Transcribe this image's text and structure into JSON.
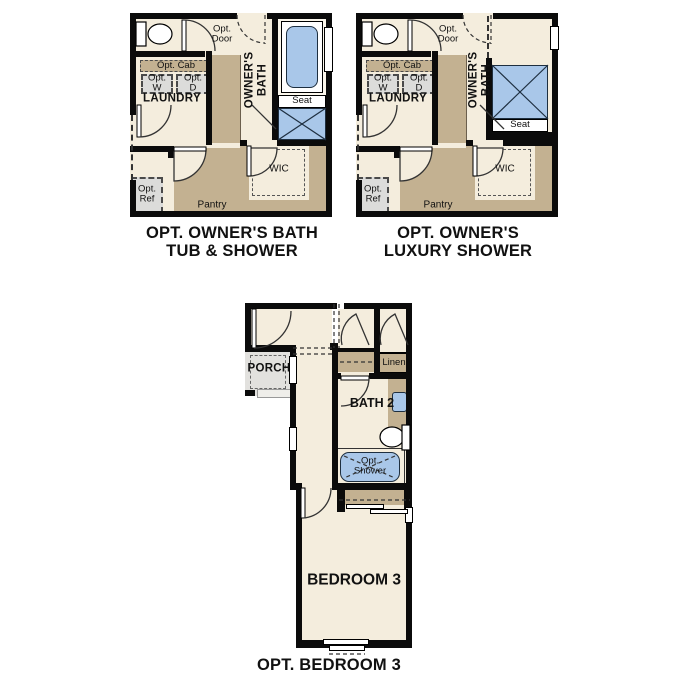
{
  "colors": {
    "background": "#ffffff",
    "floor_cream": "#F4EDDD",
    "counter_tan": "#C3B191",
    "optional_gray": "#DCDCDA",
    "fixture_blue": "#A9C7E9",
    "fixture_border": "#1E2F40",
    "wall_black": "#0b0b0b"
  },
  "plan_tub_shower": {
    "caption_line1": "OPT. OWNER'S BATH",
    "caption_line2": "TUB & SHOWER",
    "labels": {
      "opt_door_1": "Opt.",
      "opt_door_2": "Door",
      "owners_bath_1": "OWNER'S",
      "owners_bath_2": "BATH",
      "seat": "Seat",
      "opt_cab": "Opt. Cab",
      "opt_w_1": "Opt.",
      "opt_w_2": "W",
      "opt_d_1": "Opt.",
      "opt_d_2": "D",
      "laundry": "LAUNDRY",
      "opt_ref_1": "Opt.",
      "opt_ref_2": "Ref",
      "pantry": "Pantry",
      "wic": "WIC"
    }
  },
  "plan_luxury_shower": {
    "caption_line1": "OPT. OWNER'S",
    "caption_line2": "LUXURY SHOWER",
    "labels": {
      "opt_door_1": "Opt.",
      "opt_door_2": "Door",
      "owners_bath_1": "OWNER'S",
      "owners_bath_2": "BATH",
      "seat": "Seat",
      "opt_cab": "Opt. Cab",
      "opt_w_1": "Opt.",
      "opt_w_2": "W",
      "opt_d_1": "Opt.",
      "opt_d_2": "D",
      "laundry": "LAUNDRY",
      "opt_ref_1": "Opt.",
      "opt_ref_2": "Ref",
      "pantry": "Pantry",
      "wic": "WIC"
    }
  },
  "plan_bedroom3": {
    "caption": "OPT. BEDROOM 3",
    "labels": {
      "porch": "PORCH",
      "linen": "Linen",
      "bath2": "BATH 2",
      "opt_shower_1": "Opt.",
      "opt_shower_2": "Shower",
      "bedroom3": "BEDROOM 3"
    }
  }
}
